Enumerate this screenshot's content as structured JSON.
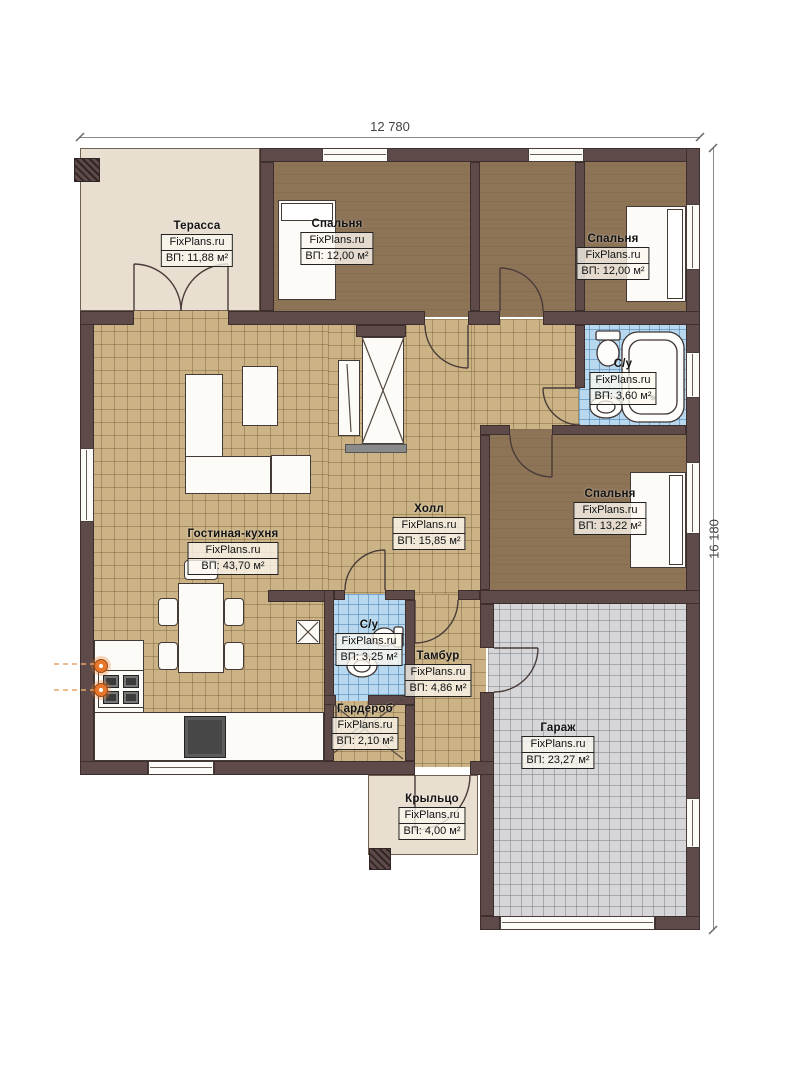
{
  "plan": {
    "dimensions": {
      "width_label": "12 780",
      "height_label": "16 180"
    },
    "rooms": [
      {
        "name": "Терасса",
        "brand": "FixPlans.ru",
        "area": "ВП: 11,88 м²"
      },
      {
        "name": "Спальня",
        "brand": "FixPlans.ru",
        "area": "ВП: 12,00 м²"
      },
      {
        "name": "Спальня",
        "brand": "FixPlans.ru",
        "area": "ВП: 12,00 м²"
      },
      {
        "name": "С/у",
        "brand": "FixPlans.ru",
        "area": "ВП: 3,60 м²"
      },
      {
        "name": "Спальня",
        "brand": "FixPlans.ru",
        "area": "ВП: 13,22 м²"
      },
      {
        "name": "Холл",
        "brand": "FixPlans.ru",
        "area": "ВП: 15,85 м²"
      },
      {
        "name": "Гостиная-кухня",
        "brand": "FixPlans.ru",
        "area": "ВП: 43,70 м²"
      },
      {
        "name": "С/у",
        "brand": "FixPlans.ru",
        "area": "ВП: 3,25 м²"
      },
      {
        "name": "Тамбур",
        "brand": "FixPlans.ru",
        "area": "ВП: 4,86 м²"
      },
      {
        "name": "Гардероб",
        "brand": "FixPlans.ru",
        "area": "ВП: 2,10 м²"
      },
      {
        "name": "Гараж",
        "brand": "FixPlans.ru",
        "area": "ВП: 23,27 м²"
      },
      {
        "name": "Крыльцо",
        "brand": "FixPlans.ru",
        "area": "ВП: 4,00 м²"
      }
    ]
  },
  "colors": {
    "wall": "#5d4a49",
    "bedroomFloor": "#8d7457",
    "tileFloor": "#cbb385",
    "bathFloor": "#b7d8ef",
    "garageFloor": "#d6d6d8",
    "outdoor": "#e9dfd1",
    "accent": "#e8762c"
  }
}
